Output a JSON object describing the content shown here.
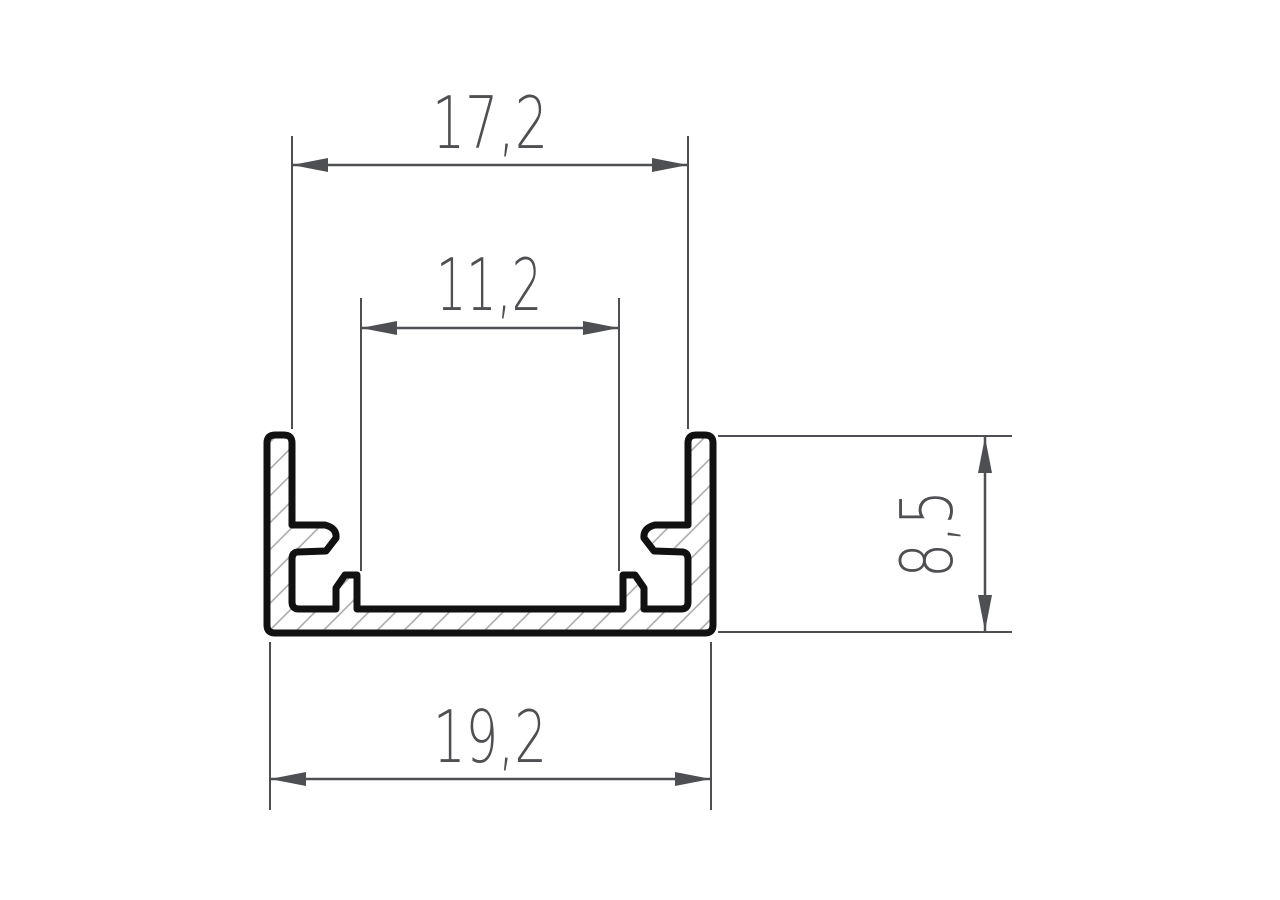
{
  "dimensions": {
    "top_inner_width": "17,2",
    "seat_inner_width": "11,2",
    "side_height": "8,5",
    "overall_width": "19,2"
  },
  "colors": {
    "background": "#ffffff",
    "outline": "#111111",
    "hatch": "#a6a6a6",
    "dimension": "#4e4f52"
  }
}
